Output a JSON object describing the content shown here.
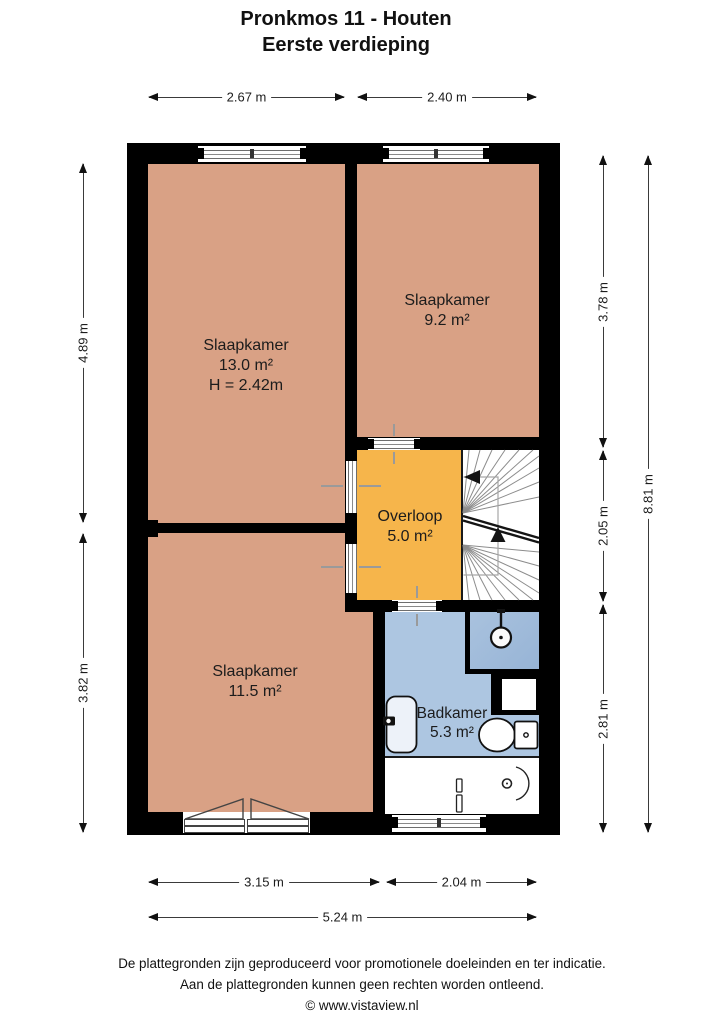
{
  "title": {
    "line1": "Pronkmos 11 - Houten",
    "line2": "Eerste verdieping"
  },
  "rooms": {
    "bedroom_large": {
      "name": "Slaapkamer",
      "area": "13.0 m²",
      "ceiling_height": "H = 2.42m"
    },
    "bedroom_right": {
      "name": "Slaapkamer",
      "area": "9.2 m²"
    },
    "bedroom_bottom": {
      "name": "Slaapkamer",
      "area": "11.5 m²"
    },
    "landing": {
      "name": "Overloop",
      "area": "5.0 m²"
    },
    "bathroom": {
      "name": "Badkamer",
      "area": "5.3 m²"
    }
  },
  "dimensions": {
    "top_left": "2.67 m",
    "top_right": "2.40 m",
    "left_upper": "4.89 m",
    "left_lower": "3.82 m",
    "right_upper": "3.78 m",
    "right_middle": "2.05 m",
    "right_lower": "2.81 m",
    "right_total": "8.81 m",
    "bottom_left": "3.15 m",
    "bottom_right": "2.04 m",
    "bottom_total": "5.24 m"
  },
  "footer": {
    "line1": "De plattegronden zijn geproduceerd voor promotionele doeleinden en ter indicatie.",
    "line2": "Aan de plattegronden kunnen geen rechten worden ontleend.",
    "line3": "© www.vistaview.nl"
  },
  "colors": {
    "wall": "#000000",
    "bedroom_fill": "#d9a185",
    "landing_fill": "#f6b54b",
    "bathroom_fill": "#adc6e1",
    "shower_fill": "#9fbbda",
    "stairs_fill": "#ffffff"
  }
}
